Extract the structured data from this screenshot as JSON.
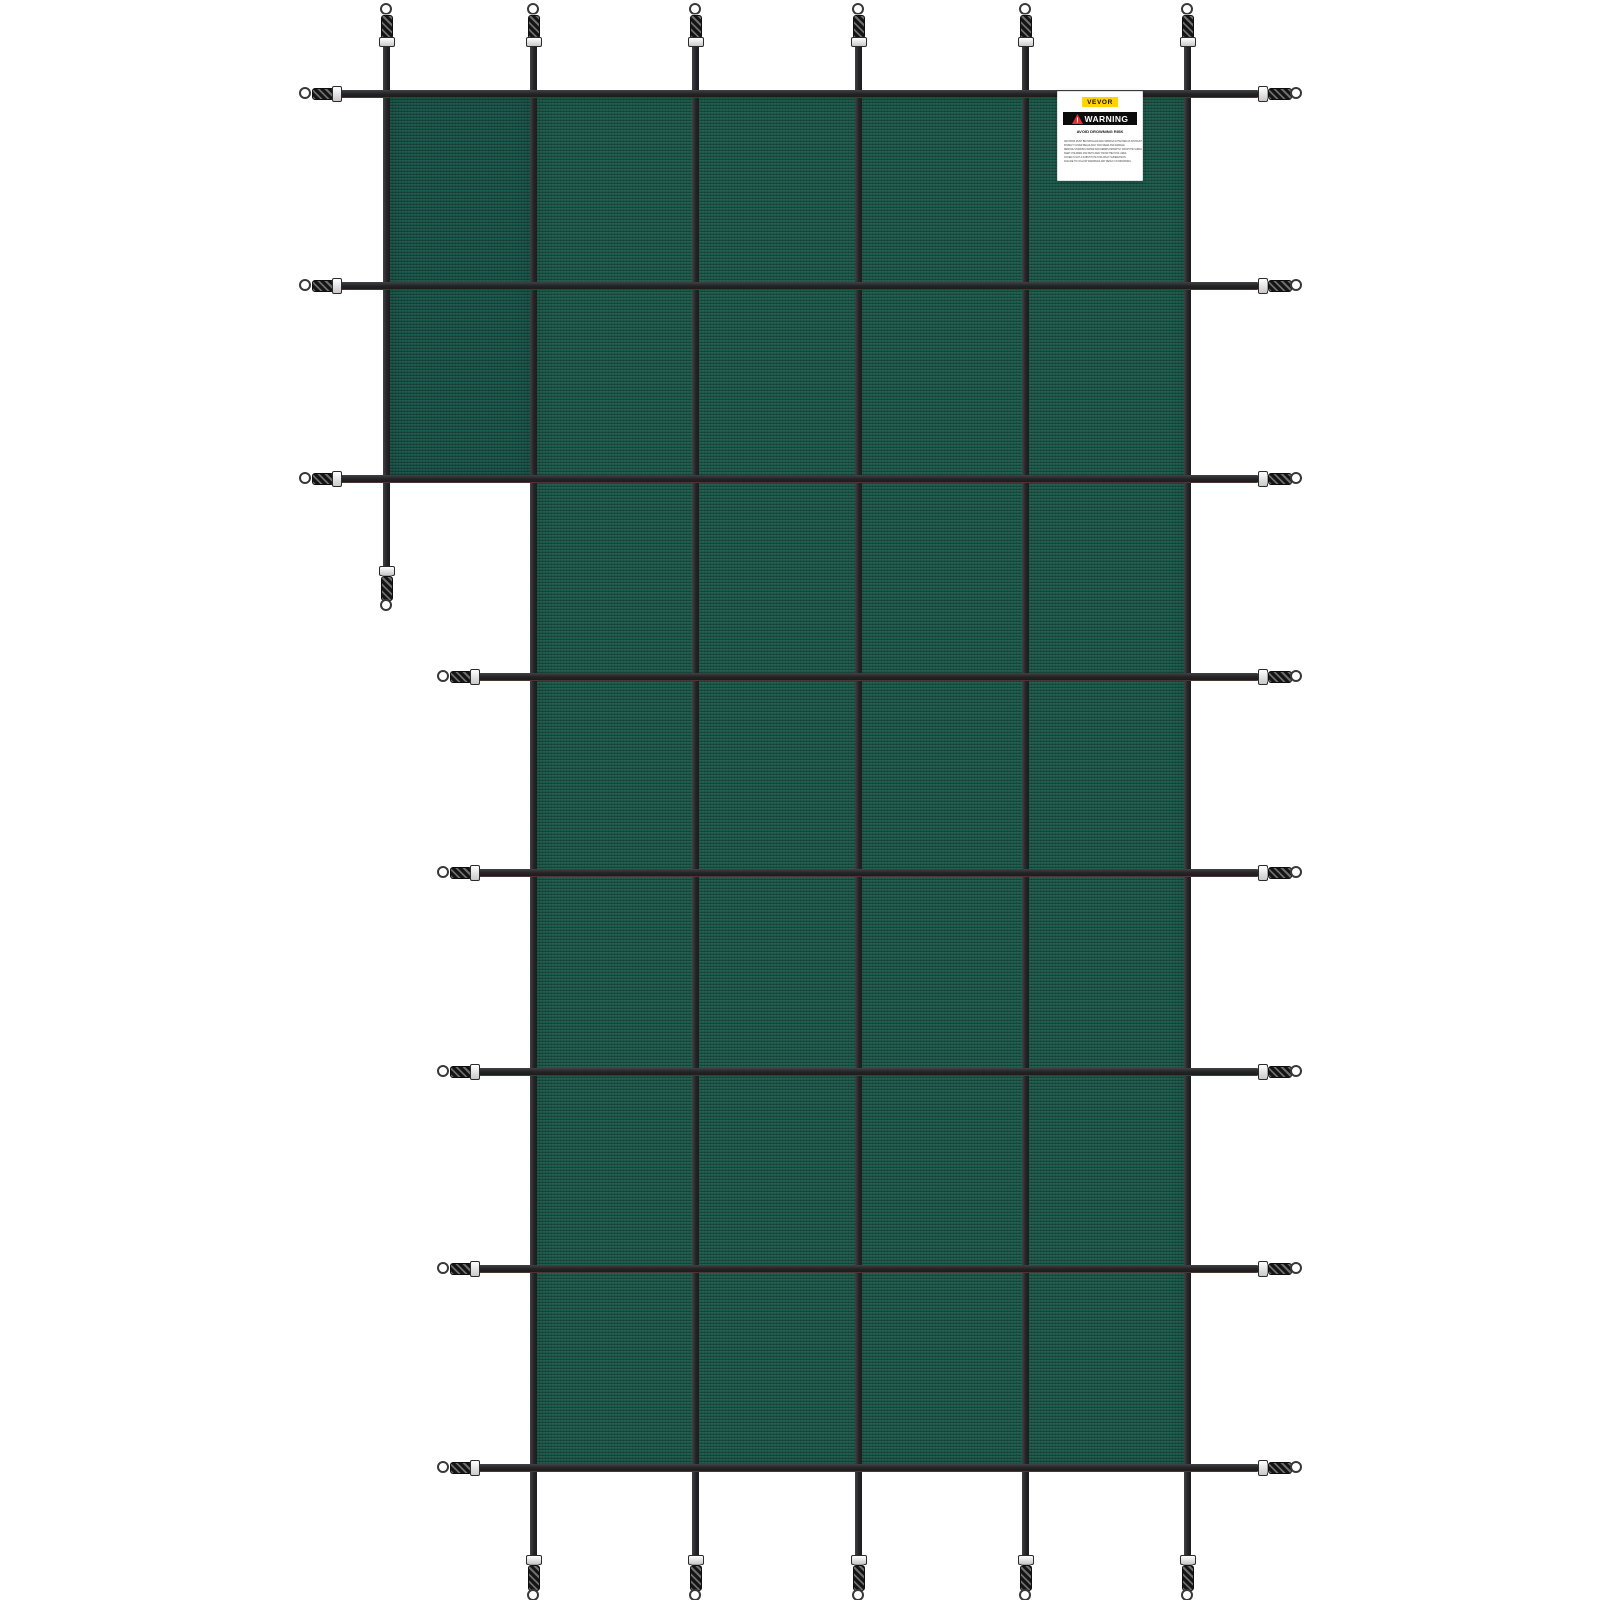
{
  "image": {
    "description": "Product photo of a green mesh rectangular pool safety cover with a left step section, black reinforcing strap grid, and perimeter spring anchors with D-rings on a white background",
    "background_color": "#ffffff"
  },
  "cover": {
    "mesh_color": "#1E5B4C",
    "strap_color": "#2B2B2D",
    "hardware_color": "#ffffff",
    "grid_columns": 6,
    "grid_rows": 8,
    "shape": "rectangle with step notch at upper left"
  },
  "label": {
    "brand": "VEVOR",
    "brand_bg": "#FFD400",
    "warning_title": "WARNING",
    "warning_title_bg": "#0C0C0C",
    "warning_triangle_color": "#E03131",
    "heading": "AVOID DROWNING RISK",
    "lines": [
      "ANCHORS MUST BE INSTALLED AND SPRINGS ATTACHED AS INSTRUCTED",
      "INSPECT COVER REGULARLY FOR WEAR AND DAMAGE",
      "REMOVE STANDING WATER AND DEBRIS PROMPTLY FROM THE SURFACE OF THE COVER",
      "KEEP CHILDREN AND PETS AWAY FROM THE POOL AREA",
      "COVER IS NOT A SUBSTITUTE FOR ADULT SUPERVISION",
      "FAILURE TO FOLLOW WARNINGS MAY RESULT IN DROWNING"
    ]
  }
}
